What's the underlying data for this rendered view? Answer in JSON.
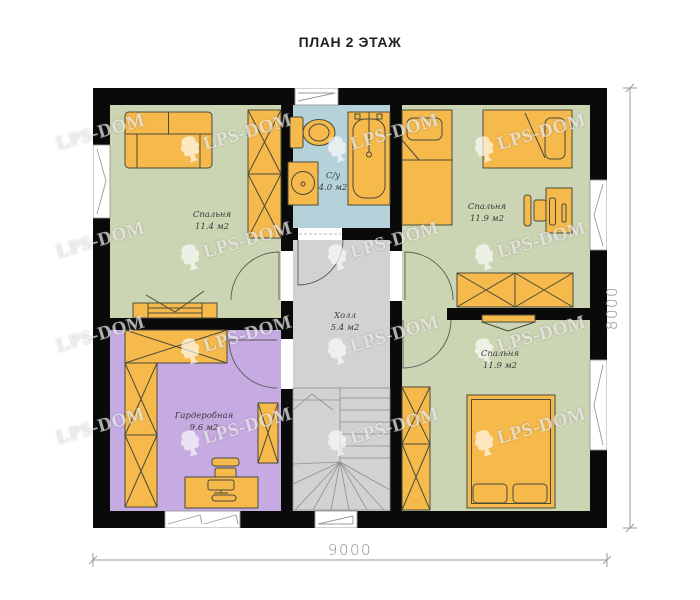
{
  "title": "ПЛАН 2 ЭТАЖ",
  "watermark": {
    "text": "LPS-DOM"
  },
  "dimensions": {
    "bottom": "9000",
    "right": "8000"
  },
  "rooms": {
    "bedroom_top_left": {
      "name": "Спальня",
      "area": "11.4 м2"
    },
    "bathroom": {
      "name": "С/у",
      "area": "4.0 м2"
    },
    "bedroom_top_right": {
      "name": "Спальня",
      "area": "11.9 м2"
    },
    "hall": {
      "name": "Холл",
      "area": "5.4 м2"
    },
    "wardrobe_room": {
      "name": "Гардеробная",
      "area": "9.6 м2"
    },
    "bedroom_bottom_right": {
      "name": "Спальня",
      "area": "11.9 м2"
    }
  },
  "colors": {
    "wall": "#0a0a0a",
    "bedroom_floor": "#ccd5b3",
    "bathroom_floor": "#b5d1d9",
    "hall_floor": "#d2d2d2",
    "wardrobe_floor": "#c6aae2",
    "furniture": "#f6b94b",
    "furniture_outline": "#4a4a3a"
  }
}
